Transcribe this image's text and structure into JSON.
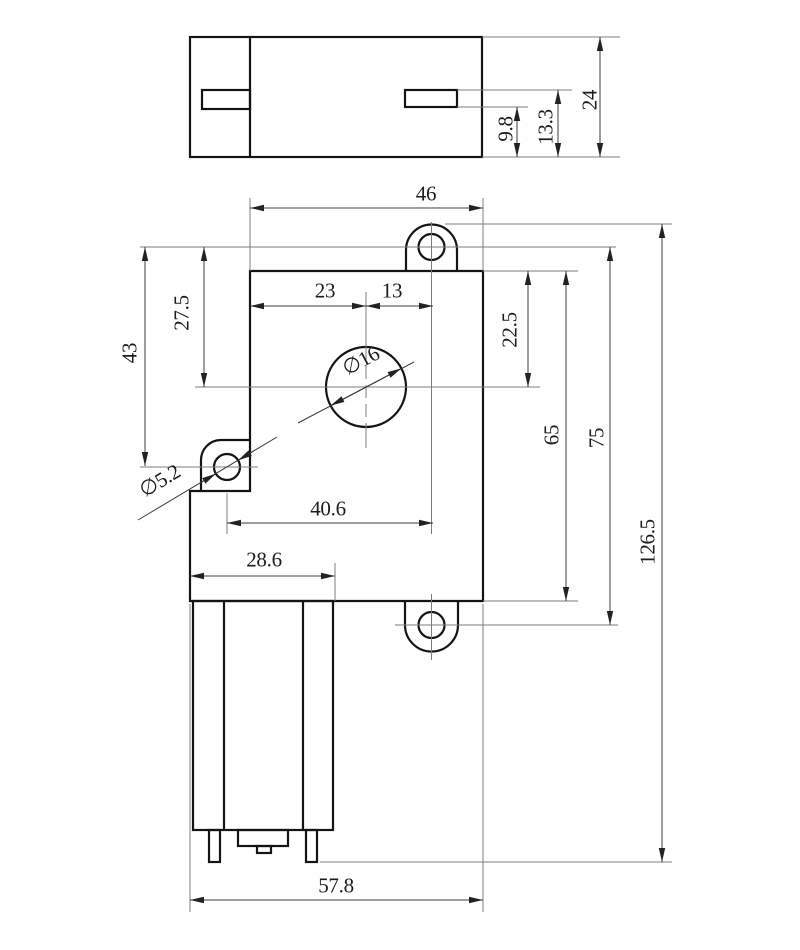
{
  "colors": {
    "background": "#ffffff",
    "outline": "#141414",
    "dimension": "#3c3c3c"
  },
  "top_view": {
    "overall_depth": "24",
    "slot_top_to_base": "13.3",
    "slot_bottom_to_base": "9.8"
  },
  "front_view": {
    "gearbox_width": "46",
    "center_to_left_edge": "23",
    "center_to_ear": "13",
    "ear_to_center_vertical": "27.5",
    "ear_to_tab_vertical": "43",
    "top_to_center_vertical": "22.5",
    "gearbox_height": "65",
    "ear_spacing": "75",
    "overall_height": "126.5",
    "tab_to_ear_horizontal": "40.6",
    "motor_width": "28.6",
    "overall_width": "57.8",
    "output_hole_diameter": "∅16",
    "mount_hole_diameter": "∅5.2"
  }
}
